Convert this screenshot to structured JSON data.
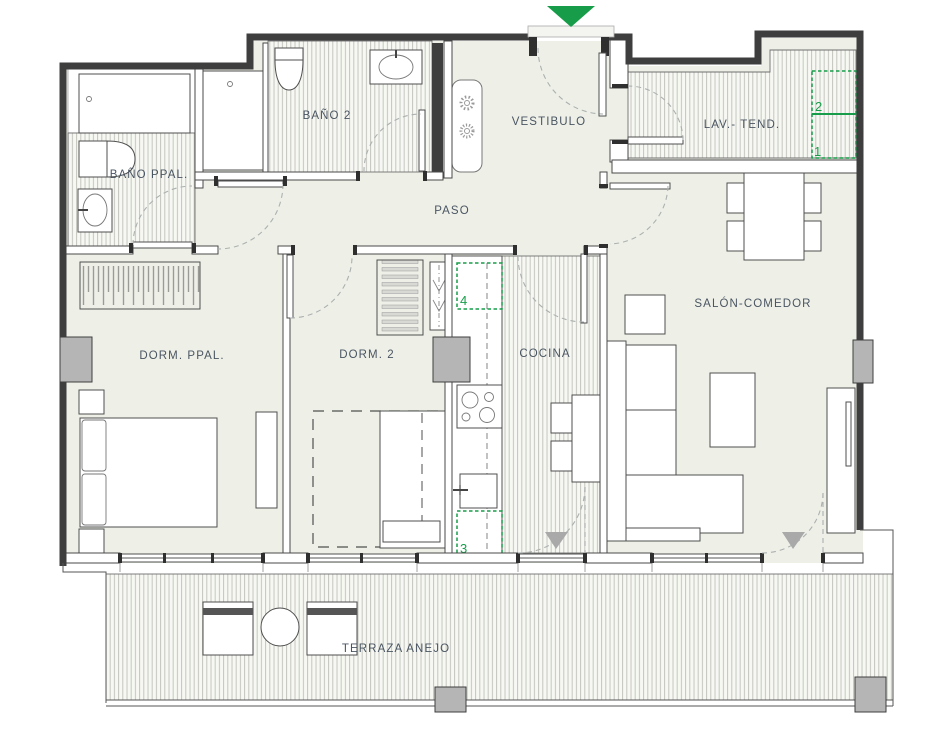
{
  "colors": {
    "accent_green": "#179d49",
    "wall_dark": "#3e3e3e",
    "floor": "#eef0e8",
    "hatch_line": "#c3c6bd",
    "label_text": "#4a5562"
  },
  "rooms": [
    {
      "id": "bano-ppal",
      "label": "BAÑO PPAL."
    },
    {
      "id": "bano-2",
      "label": "BAÑO 2"
    },
    {
      "id": "vestibulo",
      "label": "VESTIBULO"
    },
    {
      "id": "lav-tend",
      "label": "LAV.- TEND."
    },
    {
      "id": "paso",
      "label": "PASO"
    },
    {
      "id": "dorm-ppal",
      "label": "DORM. PPAL."
    },
    {
      "id": "dorm-2",
      "label": "DORM. 2"
    },
    {
      "id": "cocina",
      "label": "COCINA"
    },
    {
      "id": "salon-comedor",
      "label": "SALÓN-COMEDOR"
    },
    {
      "id": "terraza",
      "label": "TERRAZA ANEJO"
    }
  ],
  "markers": [
    {
      "label": "1"
    },
    {
      "label": "2"
    },
    {
      "label": "3"
    },
    {
      "label": "4"
    }
  ],
  "icons": {
    "entrance": "entrance-arrow",
    "heater": "sun",
    "draft": "down-triangle"
  }
}
